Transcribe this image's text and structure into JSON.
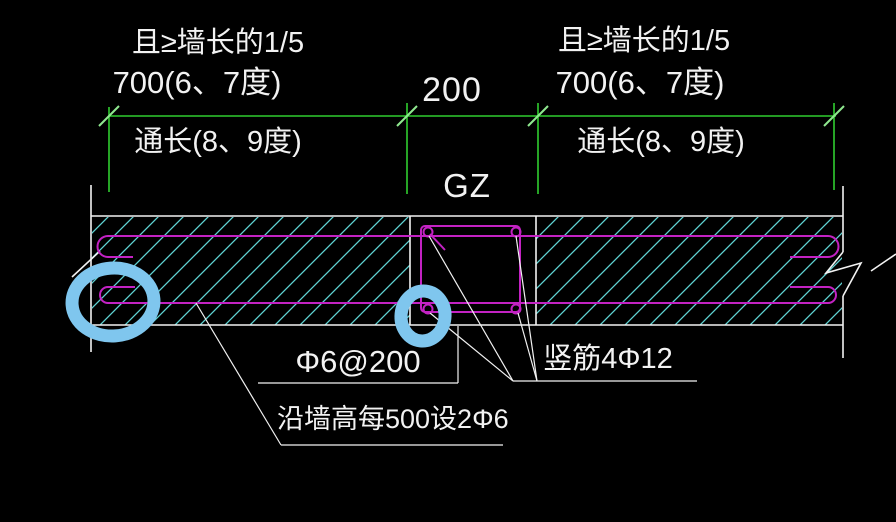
{
  "drawing_type": "wall-column reinforcement detail (CAD screenshot with hand-drawn highlights)",
  "colors": {
    "background": "#000000",
    "dimension_green": "#2FCE2F",
    "tick_green": "#8FE88F",
    "hatch_cyan": "#5FD3D3",
    "rebar_magenta": "#C322C3",
    "outline_white": "#F2F2F2",
    "highlight_blue": "#7FC6EE"
  },
  "dimensions": {
    "left_segment": {
      "above_line_1": "且≥墙长的1/5",
      "above_line_2": "700(6、7度)",
      "below_line": "通长(8、9度)"
    },
    "middle_segment": {
      "value": "200"
    },
    "right_segment": {
      "above_line_1": "且≥墙长的1/5",
      "above_line_2": "700(6、7度)",
      "below_line": "通长(8、9度)"
    }
  },
  "labels": {
    "column": "GZ",
    "stirrup_spacing": "Φ6@200",
    "vertical_rebar": "竖筋4Φ12",
    "tie_bar": "沿墙高每500设2Φ6"
  },
  "highlights": {
    "count": 2,
    "description": "hand-drawn blue circles marking left wall-bar hooks and column bottom-left bar"
  }
}
